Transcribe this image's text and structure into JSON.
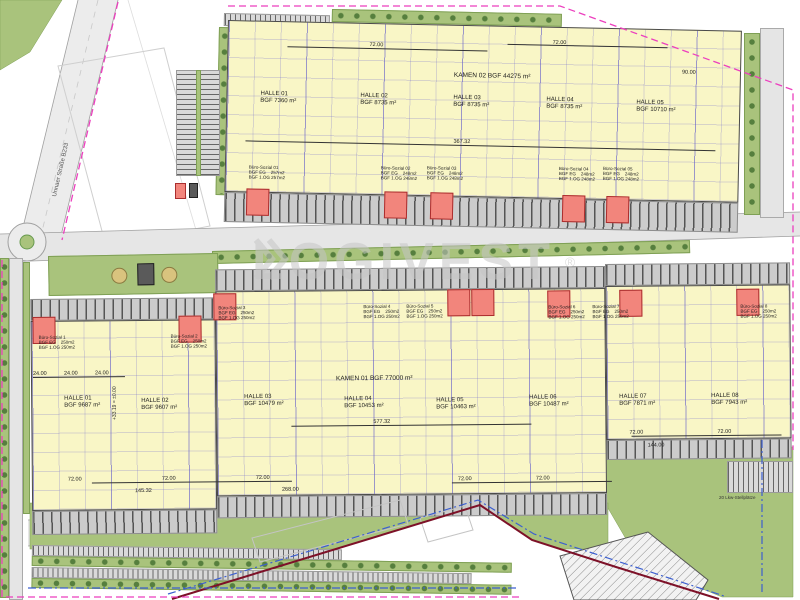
{
  "watermark": {
    "text": "LOGIVEST",
    "reg": "®"
  },
  "kamen02": {
    "title": "KAMEN 02 BGF 44275 m²",
    "title_pos": {
      "x": 227,
      "y": 47
    },
    "halls": [
      {
        "name": "HALLE 01",
        "bgf": "BGF 7360 m²",
        "x": 34,
        "y": 70
      },
      {
        "name": "HALLE 02",
        "bgf": "BGF 8735 m²",
        "x": 134,
        "y": 70
      },
      {
        "name": "HALLE 03",
        "bgf": "BGF 8735 m²",
        "x": 227,
        "y": 70
      },
      {
        "name": "HALLE 04",
        "bgf": "BGF 8735 m²",
        "x": 320,
        "y": 70
      },
      {
        "name": "HALLE 05",
        "bgf": "BGF 10710 m²",
        "x": 410,
        "y": 71
      }
    ],
    "offices": [
      {
        "name": "Büro-Sozial 01",
        "eg": "BGF EG    257m2",
        "og": "BGF 1.OG 257m2",
        "x": 24,
        "y": 144,
        "bx": 22,
        "by": 168
      },
      {
        "name": "Büro-Sozial 02",
        "eg": "BGF EG    248m2",
        "og": "BGF 1.OG 248m2",
        "x": 156,
        "y": 142,
        "bx": 160,
        "by": 168
      },
      {
        "name": "Büro-Sozial 03",
        "eg": "BGF EG    248m2",
        "og": "BGF 1.OG 248m2",
        "x": 202,
        "y": 141,
        "bx": 206,
        "by": 168
      },
      {
        "name": "Büro-Sozial 04",
        "eg": "BGF EG    248m2",
        "og": "BGF 1.OG 248m2",
        "x": 334,
        "y": 139,
        "bx": 338,
        "by": 168
      },
      {
        "name": "Büro-Sozial 05",
        "eg": "BGF EG    248m2",
        "og": "BGF 1.OG 248m2",
        "x": 378,
        "y": 138,
        "bx": 382,
        "by": 168
      }
    ],
    "dims": [
      {
        "t": "72.00",
        "x": 142,
        "y": 19
      },
      {
        "t": "72.00",
        "x": 325,
        "y": 13
      },
      {
        "t": "90.00",
        "x": 455,
        "y": 40
      },
      {
        "t": "367.32",
        "x": 228,
        "y": 114
      }
    ]
  },
  "kamen01": {
    "title": "KAMEN 01 BGF 77000 m²",
    "title_pos": {
      "x": 305,
      "y": 113
    },
    "halls": [
      {
        "name": "HALLE 01",
        "bgf": "BGF 9687 m²",
        "x": 33,
        "y": 131
      },
      {
        "name": "HALLE 02",
        "bgf": "BGF 9607 m²",
        "x": 110,
        "y": 134
      },
      {
        "name": "HALLE 03",
        "bgf": "BGF 10479 m²",
        "x": 213,
        "y": 131
      },
      {
        "name": "HALLE 04",
        "bgf": "BGF 10453 m²",
        "x": 313,
        "y": 134
      },
      {
        "name": "HALLE 05",
        "bgf": "BGF 10463 m²",
        "x": 405,
        "y": 136
      },
      {
        "name": "HALLE 06",
        "bgf": "BGF 10487 m²",
        "x": 498,
        "y": 134
      },
      {
        "name": "HALLE 07",
        "bgf": "BGF 7871 m²",
        "x": 588,
        "y": 134
      },
      {
        "name": "HALLE 08",
        "bgf": "BGF 7943 m²",
        "x": 680,
        "y": 134
      }
    ],
    "offices": [
      {
        "name": "Büro-Sozial 1",
        "eg": "BGF EG    250m2",
        "og": "BGF 1.OG 250m2",
        "x": 8,
        "y": 70,
        "bx": 2,
        "by": 52
      },
      {
        "name": "Büro-Sozial 2",
        "eg": "BGF EG    250m2",
        "og": "BGF 1.OG 250m2",
        "x": 140,
        "y": 70,
        "bx": 148,
        "by": 52
      },
      {
        "name": "Büro-Sozial 3",
        "eg": "BGF EG    250m2",
        "og": "BGF 1.OG 250m2",
        "x": 188,
        "y": 42,
        "bx": 183,
        "by": 30
      },
      {
        "name": "Büro-Sozial 4",
        "eg": "BGF EG    250m2",
        "og": "BGF 1.OG 250m2",
        "x": 333,
        "y": 42,
        "bx": 417,
        "by": 28
      },
      {
        "name": "Büro-Sozial 5",
        "eg": "BGF EG    250m2",
        "og": "BGF 1.OG 250m2",
        "x": 376,
        "y": 42,
        "bx": 441,
        "by": 28
      },
      {
        "name": "Büro-Sozial 6",
        "eg": "BGF EG    250m2",
        "og": "BGF 1.OG 250m2",
        "x": 518,
        "y": 44,
        "bx": 517,
        "by": 30
      },
      {
        "name": "Büro-Sozial 7",
        "eg": "BGF EG    250m2",
        "og": "BGF 1.OG 250m2",
        "x": 562,
        "y": 44,
        "bx": 589,
        "by": 30
      },
      {
        "name": "Büro-Sozial 8",
        "eg": "BGF EG    250m2",
        "og": "BGF 1.OG 250m2",
        "x": 710,
        "y": 45,
        "bx": 706,
        "by": 30
      }
    ],
    "dims": [
      {
        "t": "24.00",
        "x": 2,
        "y": 106
      },
      {
        "t": "24.00",
        "x": 33,
        "y": 106
      },
      {
        "t": "24.00",
        "x": 64,
        "y": 106
      },
      {
        "t": "577.32",
        "x": 342,
        "y": 157
      },
      {
        "t": "72.00",
        "x": 36,
        "y": 212
      },
      {
        "t": "72.00",
        "x": 130,
        "y": 212
      },
      {
        "t": "72.00",
        "x": 224,
        "y": 212
      },
      {
        "t": "145.32",
        "x": 103,
        "y": 224
      },
      {
        "t": "268.00",
        "x": 250,
        "y": 224
      },
      {
        "t": "72.00",
        "x": 426,
        "y": 215
      },
      {
        "t": "72.00",
        "x": 504,
        "y": 215
      },
      {
        "t": "72.00",
        "x": 598,
        "y": 170
      },
      {
        "t": "72.00",
        "x": 686,
        "y": 170
      },
      {
        "t": "144.00",
        "x": 616,
        "y": 183
      }
    ]
  },
  "annotations": [
    {
      "text": "Unnaer Straße B233",
      "x": 52,
      "y": 196,
      "size": 6,
      "angle": -77,
      "color": "#555"
    },
    {
      "text": "20 Lkw-Stellplätze",
      "x": 719,
      "y": 495,
      "size": 4.5,
      "angle": 0,
      "color": "#333"
    },
    {
      "text": "+33.19 = ±0.00",
      "x": 112,
      "y": 420,
      "size": 5,
      "angle": -90,
      "color": "#333"
    }
  ]
}
